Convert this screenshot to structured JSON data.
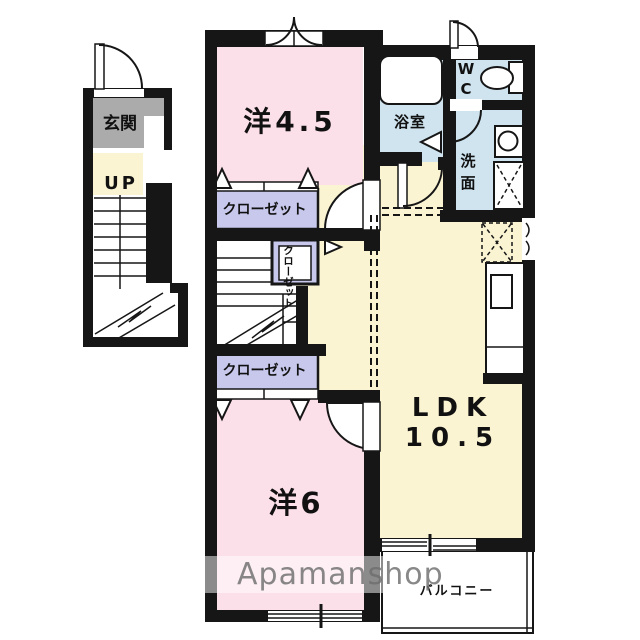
{
  "floorplan": {
    "title": "apartment-floorplan",
    "watermark": "Apamanshop",
    "entrance": {
      "genkan_label": "玄関",
      "up_label": "UP"
    },
    "rooms": {
      "western_4_5": {
        "label": "洋4.5",
        "color_key": "room_pink"
      },
      "western_6": {
        "label": "洋6",
        "color_key": "room_pink"
      },
      "ldk": {
        "label": "LDK",
        "size": "10.5",
        "color_key": "hall_yellow"
      },
      "bath": {
        "label": "浴室",
        "color_key": "wet_blue"
      },
      "wc": {
        "line1": "W",
        "line2": "C",
        "color_key": "wet_blue"
      },
      "washroom": {
        "line1": "洗",
        "line2": "面",
        "color_key": "wet_blue"
      },
      "closet_top": {
        "label": "クローゼット"
      },
      "closet_bottom": {
        "label": "クローゼット"
      },
      "closet_small": {
        "col1": "クロー",
        "col2": "ゼット"
      },
      "balcony": {
        "label": "バルコニー"
      }
    },
    "colors": {
      "room_pink": "#fbdfe9",
      "hall_yellow": "#faf4d3",
      "wet_blue": "#cfe4ef",
      "closet_lavender": "#c7c8ec",
      "entrance_gray": "#ababab",
      "wall_black": "#161616",
      "watermark_gray": "#6e6e6e"
    }
  }
}
